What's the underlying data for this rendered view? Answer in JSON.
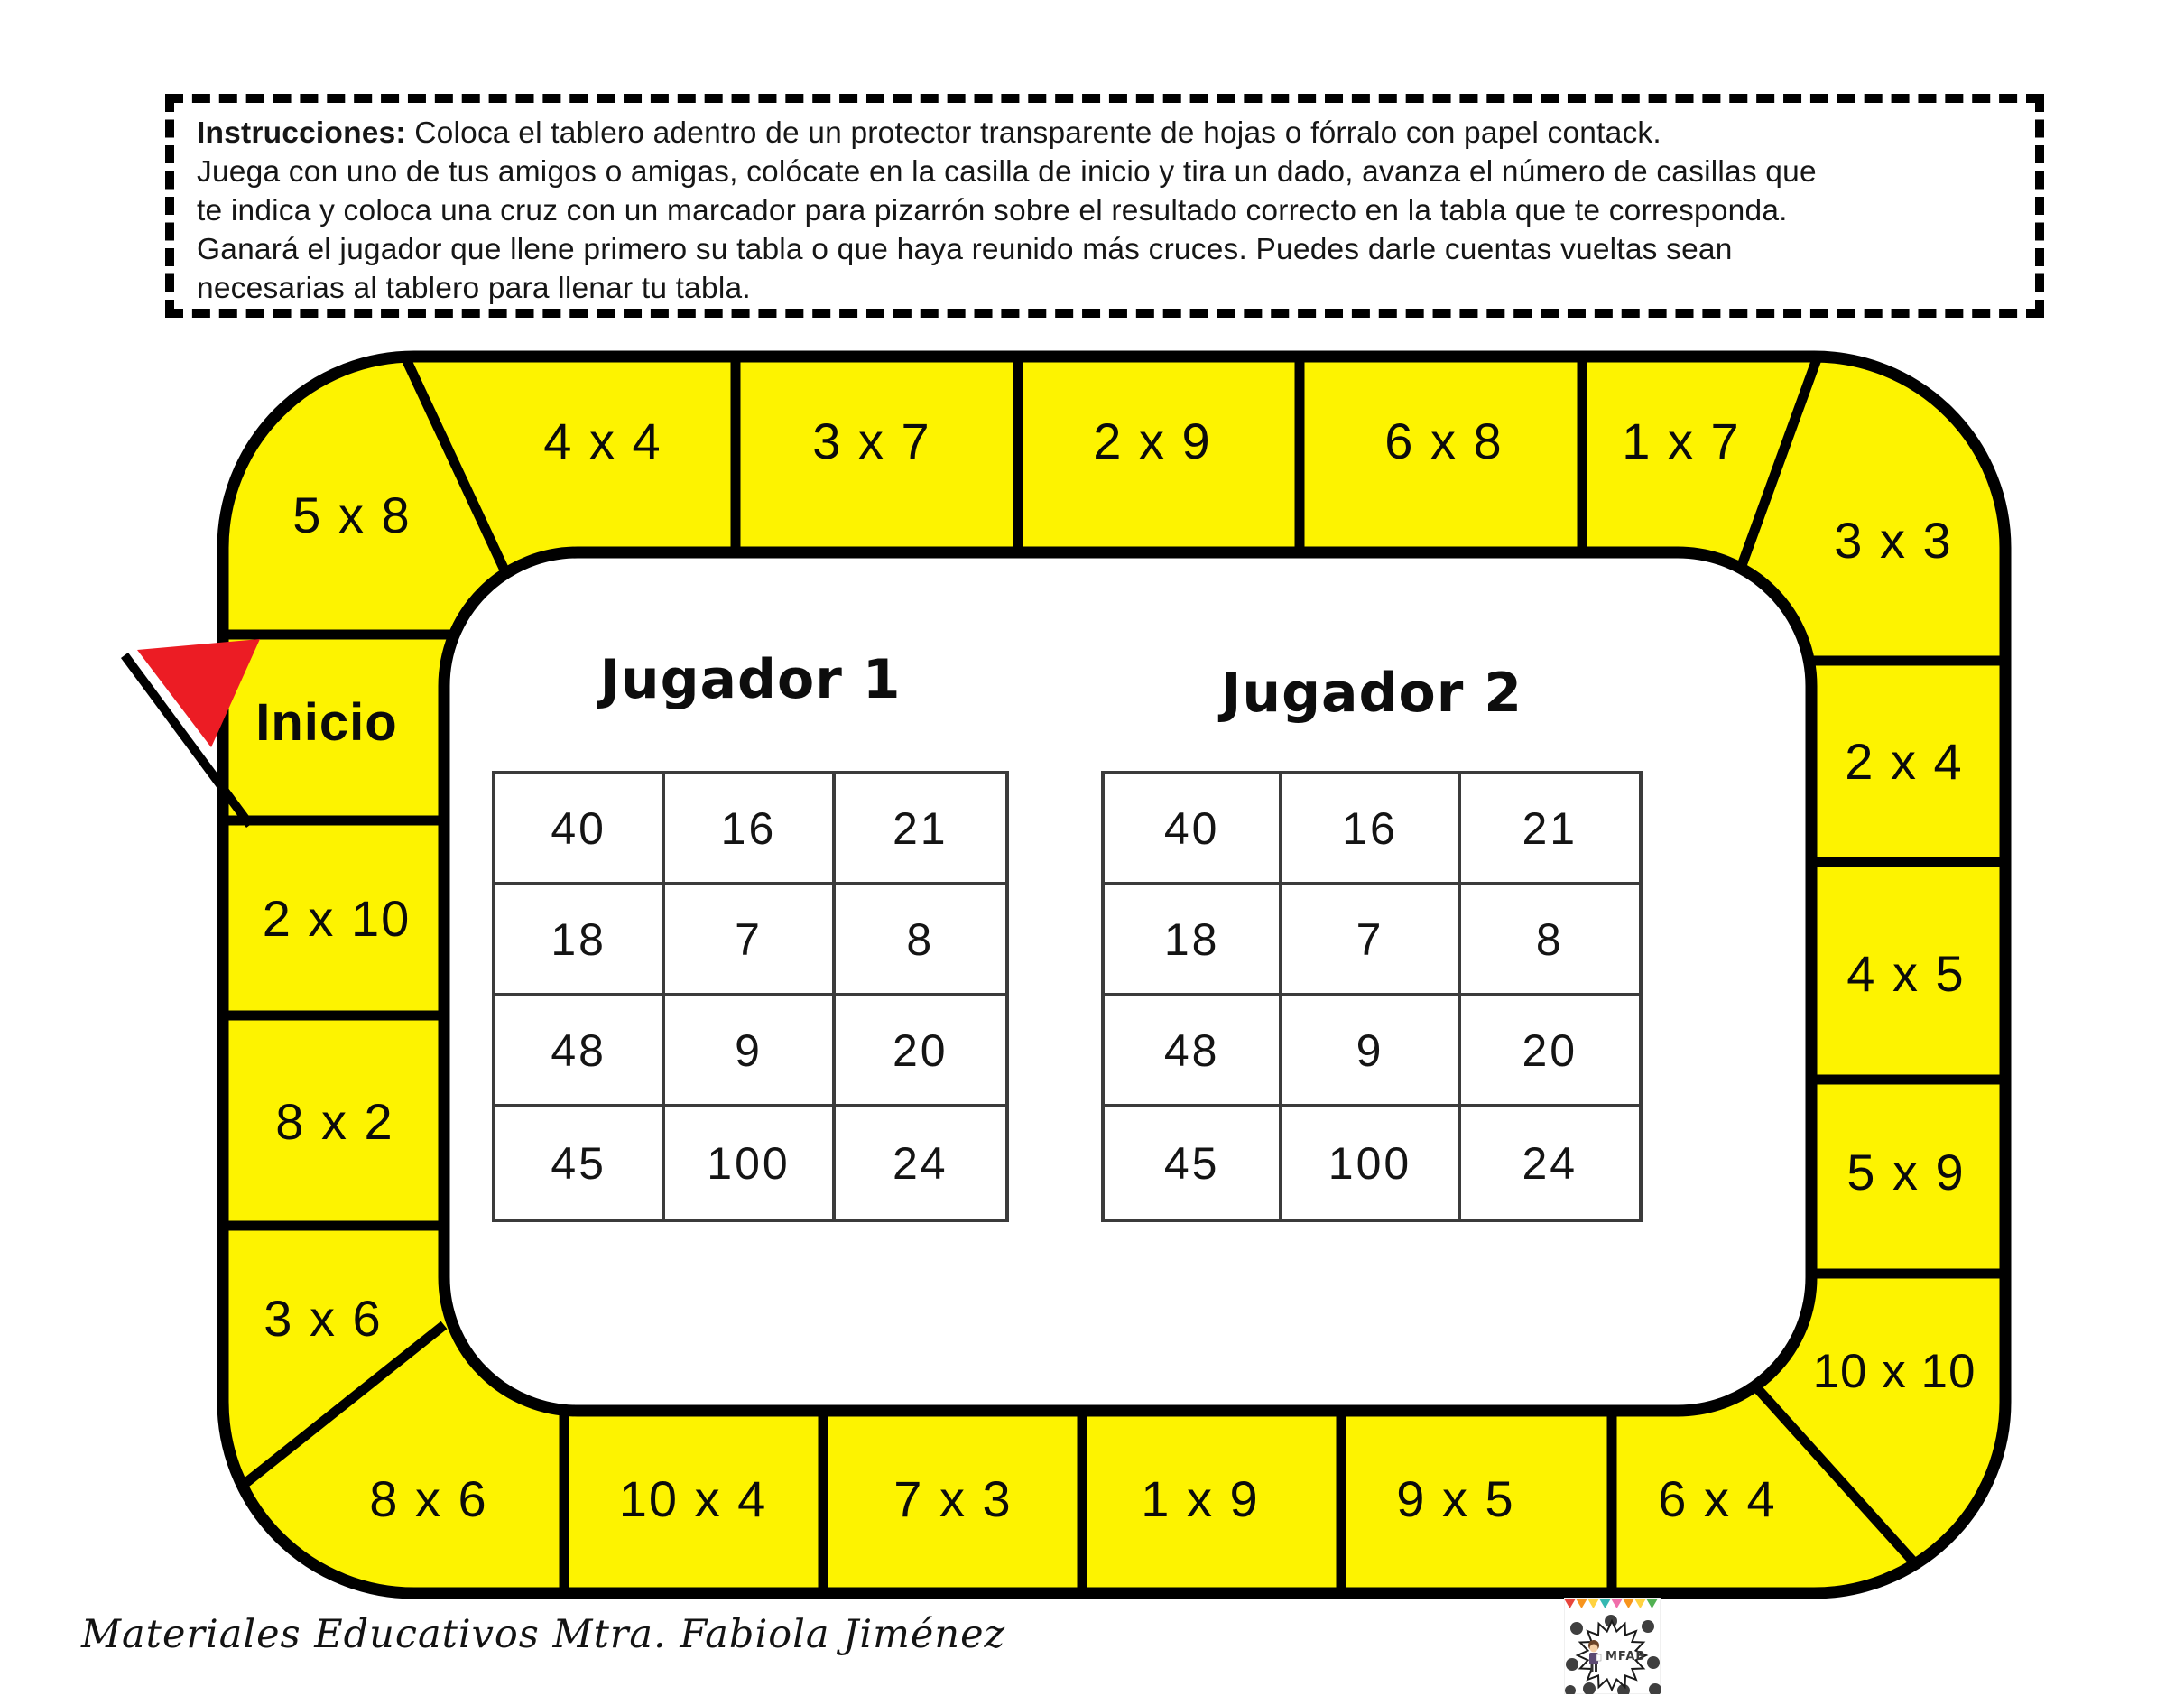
{
  "instructions": {
    "heading": "Instrucciones:",
    "line1": " Coloca el tablero adentro de un protector transparente de hojas o fórralo con papel contack.",
    "line2": "Juega con uno de tus amigos o amigas, colócate en la casilla de inicio y tira un dado, avanza el número de casillas que",
    "line3": "te indica y coloca una cruz con un marcador para pizarrón sobre el resultado correcto en la tabla que te corresponda.",
    "line4": "Ganará el jugador que llene primero su tabla o que haya reunido más cruces. Puedes darle cuentas vueltas sean",
    "line5": "necesarias al tablero para llenar tu tabla."
  },
  "board": {
    "yellow": "#FDF300",
    "line_black": "#000000",
    "flag_red": "#EC1C24",
    "cells": {
      "start": "Inicio",
      "corner_top_left": "5 x 8",
      "top_1": "4 x 4",
      "top_2": "3 x 7",
      "top_3": "2 x 9",
      "top_4": "6 x 8",
      "top_5": "1 x 7",
      "corner_top_right": "3 x 3",
      "right_1": "2 x 4",
      "right_2": "4 x 5",
      "right_3": "5 x 9",
      "corner_bottom_right": "10 x 10",
      "bottom_1": "10 x 4",
      "bottom_2": "7 x 3",
      "bottom_3": "1 x 9",
      "bottom_4": "9 x 5",
      "bottom_5": "6 x 4",
      "corner_bottom_left": "8 x 6",
      "left_1": "2 x 10",
      "left_2": "8 x 2",
      "left_3": "3 x 6"
    }
  },
  "players": [
    {
      "title": "Jugador 1",
      "grid": [
        [
          "40",
          "16",
          "21"
        ],
        [
          "18",
          "7",
          "8"
        ],
        [
          "48",
          "9",
          "20"
        ],
        [
          "45",
          "100",
          "24"
        ]
      ]
    },
    {
      "title": "Jugador 2",
      "grid": [
        [
          "40",
          "16",
          "21"
        ],
        [
          "18",
          "7",
          "8"
        ],
        [
          "48",
          "9",
          "20"
        ],
        [
          "45",
          "100",
          "24"
        ]
      ]
    }
  ],
  "footer": {
    "credit": "Materiales Educativos Mtra. Fabiola Jiménez",
    "logo_text": "MFAB"
  }
}
